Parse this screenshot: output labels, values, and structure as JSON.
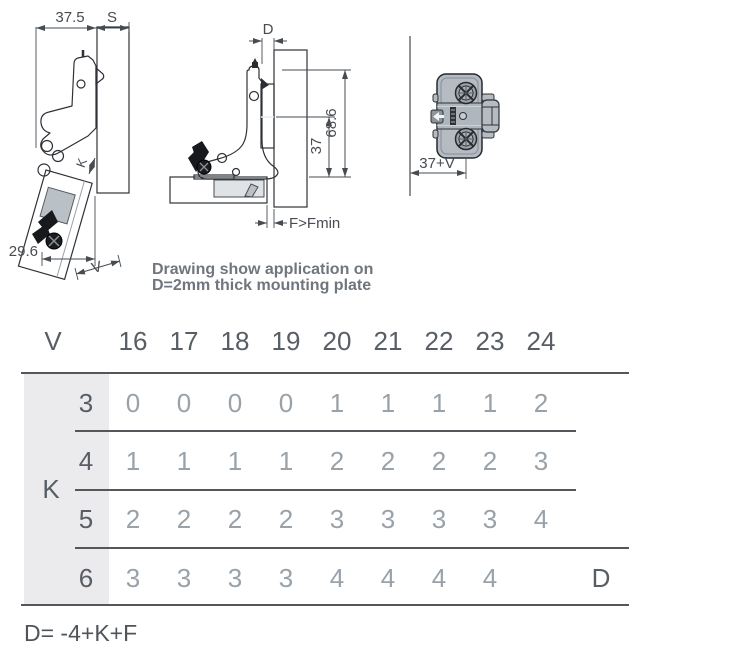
{
  "drawings": {
    "left": {
      "dim_width": "37.5",
      "dim_overlay": "S",
      "dim_crank": "K",
      "dim_bottom": "29.6",
      "dim_reveal": "V"
    },
    "middle": {
      "dim_plate": "D",
      "dim_height": "68.6",
      "dim_screw": "37",
      "dim_gap": "F>Fmin"
    },
    "right": {
      "dim_offset": "37+V"
    },
    "note_line1": "Drawing show application on",
    "note_line2": "D=2mm thick mounting plate"
  },
  "table": {
    "corner": "V",
    "group": "K",
    "cols": [
      "16",
      "17",
      "18",
      "19",
      "20",
      "21",
      "22",
      "23",
      "24"
    ],
    "rows": [
      {
        "label": "3",
        "values": [
          "0",
          "0",
          "0",
          "0",
          "1",
          "1",
          "1",
          "1",
          "2"
        ]
      },
      {
        "label": "4",
        "values": [
          "1",
          "1",
          "1",
          "1",
          "2",
          "2",
          "2",
          "2",
          "3"
        ]
      },
      {
        "label": "5",
        "values": [
          "2",
          "2",
          "2",
          "2",
          "3",
          "3",
          "3",
          "3",
          "4"
        ]
      },
      {
        "label": "6",
        "values": [
          "3",
          "3",
          "3",
          "3",
          "4",
          "4",
          "4",
          "4",
          ""
        ]
      }
    ],
    "result": "D"
  },
  "formula": "D= -4+K+F",
  "colors": {
    "accent_line": "#53565a",
    "shade": "#ebebed",
    "metal": "#aab2ba",
    "panel_dark": "#c2ccd4",
    "panel_light": "#edf1f4",
    "outline": "#2e3237",
    "dim_text": "#474c52",
    "header_text": "#585e66",
    "value_text": "#99a1a9"
  }
}
